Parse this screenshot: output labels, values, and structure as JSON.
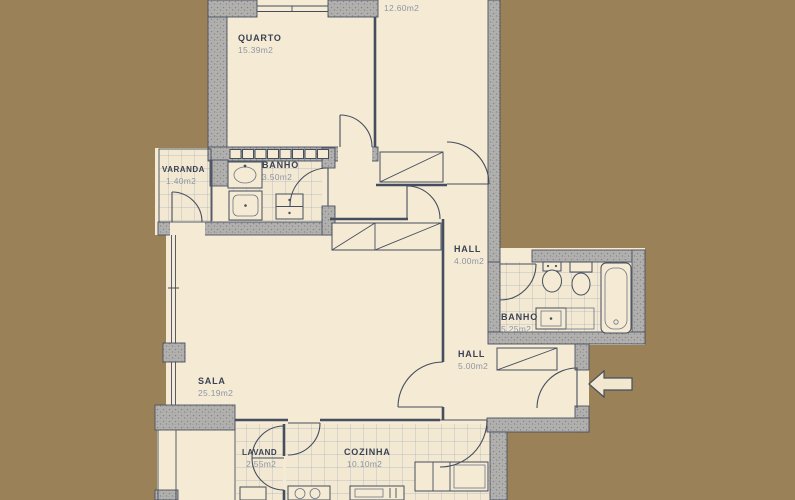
{
  "document": {
    "type": "apartment-floor-plan"
  },
  "colors": {
    "background": "#9B8158",
    "paper": "#F5EAD4",
    "wall_fill": "#B2B1AE",
    "wall_dot": "#85868B",
    "ink": "#454E5E",
    "label_text": "#3A4254",
    "area_text": "#8D96A4",
    "tile_line": "#A9B2BF"
  },
  "rooms": {
    "quarto": {
      "label": "QUARTO",
      "area": "15.39m2"
    },
    "quarto_2": {
      "area": "12.60m2"
    },
    "varanda": {
      "label": "VARANDA",
      "area": "1.40m2"
    },
    "banho_1": {
      "label": "BANHO",
      "area": "3.50m2"
    },
    "hall_1": {
      "label": "HALL",
      "area": "4.00m2"
    },
    "banho_2": {
      "label": "BANHO",
      "area": "5.25m2"
    },
    "hall_2": {
      "label": "HALL",
      "area": "5.00m2"
    },
    "sala": {
      "label": "SALA",
      "area": "25.19m2"
    },
    "lavand": {
      "label": "LAVAND",
      "area": "2.55m2"
    },
    "cozinha": {
      "label": "COZINHA",
      "area": "10.10m2"
    }
  },
  "icons": {
    "entrance_arrow": "entrance-direction-left"
  }
}
